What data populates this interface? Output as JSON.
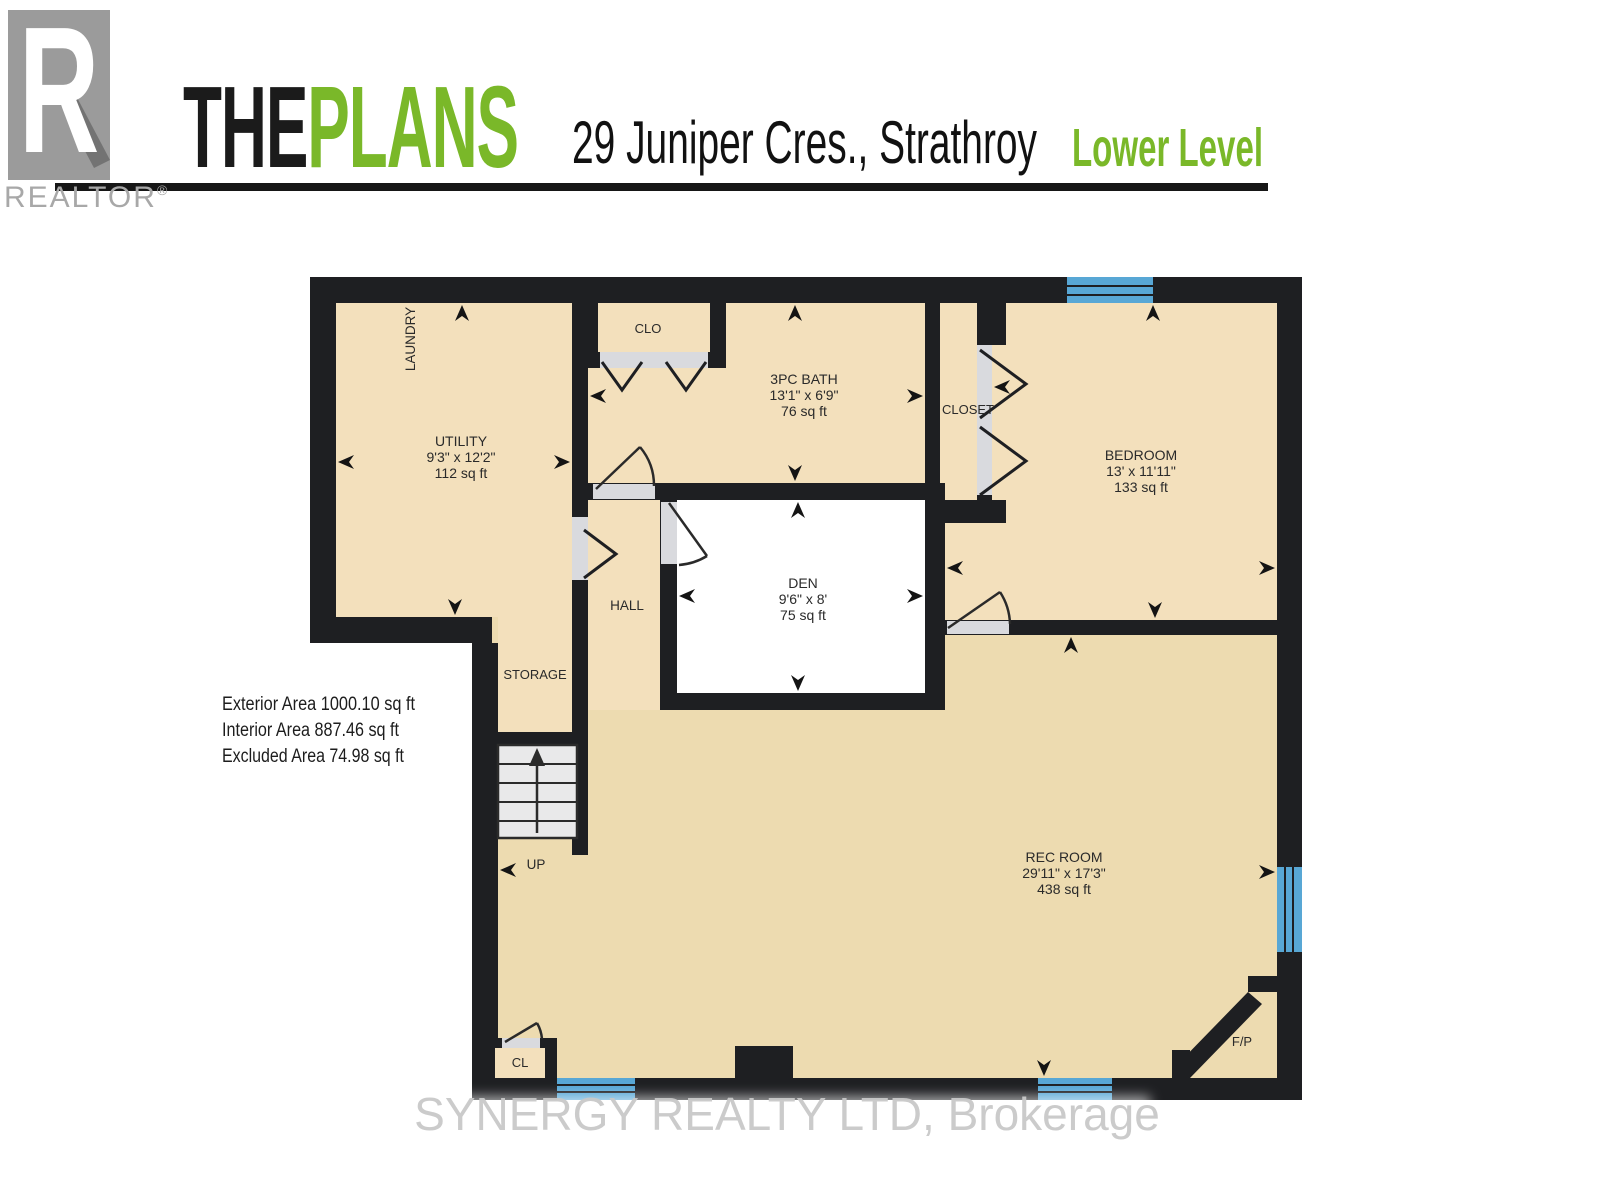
{
  "header": {
    "logo_letter": "R",
    "realtor_wordmark": "REALTOR",
    "registered_mark": "®",
    "brand_the": "THE",
    "brand_plans": "PLANS",
    "address": "29 Juniper Cres., Strathroy",
    "level": "Lower Level"
  },
  "areas": {
    "exterior": "Exterior Area 1000.10 sq ft",
    "interior": "Interior Area 887.46 sq ft",
    "excluded": "Excluded Area 74.98 sq ft"
  },
  "watermark": {
    "text": "SYNERGY REALTY LTD, Brokerage"
  },
  "plan": {
    "rooms": [
      {
        "id": "utility",
        "name": "UTILITY",
        "dims": "9'3\" x 12'2\"",
        "area": "112 sq ft"
      },
      {
        "id": "laundry",
        "name": "LAUNDRY"
      },
      {
        "id": "clo",
        "name": "CLO"
      },
      {
        "id": "bath",
        "name": "3PC BATH",
        "dims": "13'1\" x 6'9\"",
        "area": "76 sq ft"
      },
      {
        "id": "closet",
        "name": "CLOSET"
      },
      {
        "id": "bedroom",
        "name": "BEDROOM",
        "dims": "13' x 11'11\"",
        "area": "133 sq ft"
      },
      {
        "id": "den",
        "name": "DEN",
        "dims": "9'6\" x 8'",
        "area": "75 sq ft"
      },
      {
        "id": "hall",
        "name": "HALL"
      },
      {
        "id": "storage",
        "name": "STORAGE"
      },
      {
        "id": "stairs",
        "name": "UP"
      },
      {
        "id": "rec-room",
        "name": "REC ROOM",
        "dims": "29'11\" x 17'3\"",
        "area": "438 sq ft"
      },
      {
        "id": "cl",
        "name": "CL"
      },
      {
        "id": "fireplace",
        "name": "F/P"
      }
    ],
    "colors": {
      "brand_green": "#7ab829",
      "wall": "#1e1f22",
      "floor_light": "#f3e0bc",
      "floor_dark": "#eddbb0",
      "excluded_floor": "#ffffff",
      "window_blue": "#58a7d5",
      "door_opening_gray": "#d9dade",
      "stairs_gray": "#e9e9ea",
      "logo_gray": "#9b9b9b",
      "watermark_gray": "#c9c9c9"
    }
  }
}
